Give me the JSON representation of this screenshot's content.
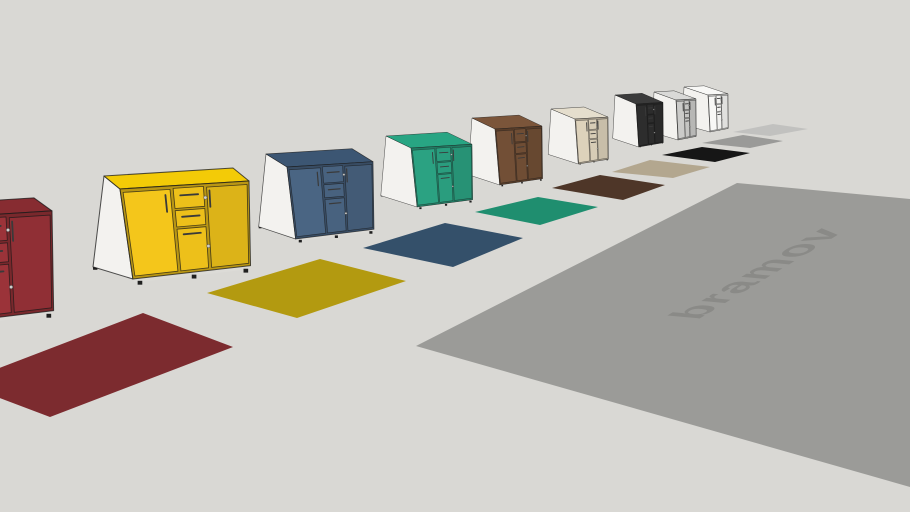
{
  "viewport": {
    "background": "#d9d8d4"
  },
  "brand": {
    "text": "bramov",
    "color": "#8a8a87"
  },
  "floor_plane": {
    "color": "#9b9b98"
  },
  "shared": {
    "side_panel_color": "#f3f2ef",
    "outline_color": "rgba(25,25,25,0.75)",
    "handle_color": "#3a3a3a",
    "hinge_color": "#cfcfcd",
    "feet_color": "#1f1f1f",
    "base_strip_color": "#dcdbd7"
  },
  "cabinets": [
    {
      "name": "dark-red",
      "front": "#9b3339",
      "top": "#872c31",
      "swatch": "#7c2b2f"
    },
    {
      "name": "yellow",
      "front": "#edc01a",
      "top": "#f3cb07",
      "swatch": "#b39a10"
    },
    {
      "name": "steel-blue",
      "front": "#48627f",
      "top": "#3c5673",
      "swatch": "#34506a"
    },
    {
      "name": "teal-green",
      "front": "#2a9d7e",
      "top": "#28a583",
      "swatch": "#1f8e6f"
    },
    {
      "name": "walnut-brown",
      "front": "#6f4d34",
      "top": "#7b553a",
      "swatch": "#4e3628"
    },
    {
      "name": "beige-oak",
      "front": "#d7ccb6",
      "top": "#e5decd",
      "swatch": "#b3a78f"
    },
    {
      "name": "black",
      "front": "#2c2c2c",
      "top": "#3b3b3b",
      "swatch": "#161616"
    },
    {
      "name": "light-gray",
      "front": "#c5c5c3",
      "top": "#d9d9d7",
      "swatch": "#9a9a98"
    },
    {
      "name": "white",
      "front": "#f1f1ef",
      "top": "#f8f8f6",
      "swatch": "#c1c1bf"
    }
  ]
}
